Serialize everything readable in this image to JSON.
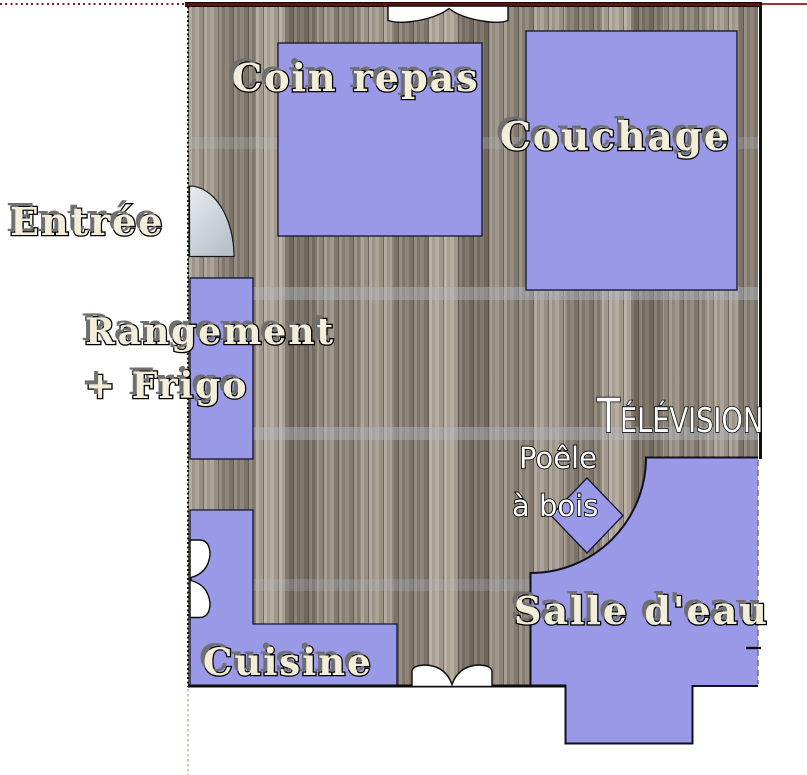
{
  "colors": {
    "room_fill": "#9a99e8",
    "wood_base": "#9b9288",
    "top_wall_red": "#5c1414",
    "axis_red_dotted": "#801d1d",
    "axis_red_solid": "#a23232",
    "axis_green": "#b7d5b7",
    "label_cream": "#f3eed9",
    "label_white": "#ffffff",
    "outline": "#000000"
  },
  "labels": {
    "coin_repas": "Coin repas",
    "couchage": "Couchage",
    "entree": "Entrée",
    "rangement_line1": "Rangement",
    "rangement_line2": "+ Frigo",
    "television": "Télévision",
    "poele_line1": "Poêle",
    "poele_line2": "à bois",
    "salle_eau": "Salle d'eau",
    "cuisine": "Cuisine"
  }
}
